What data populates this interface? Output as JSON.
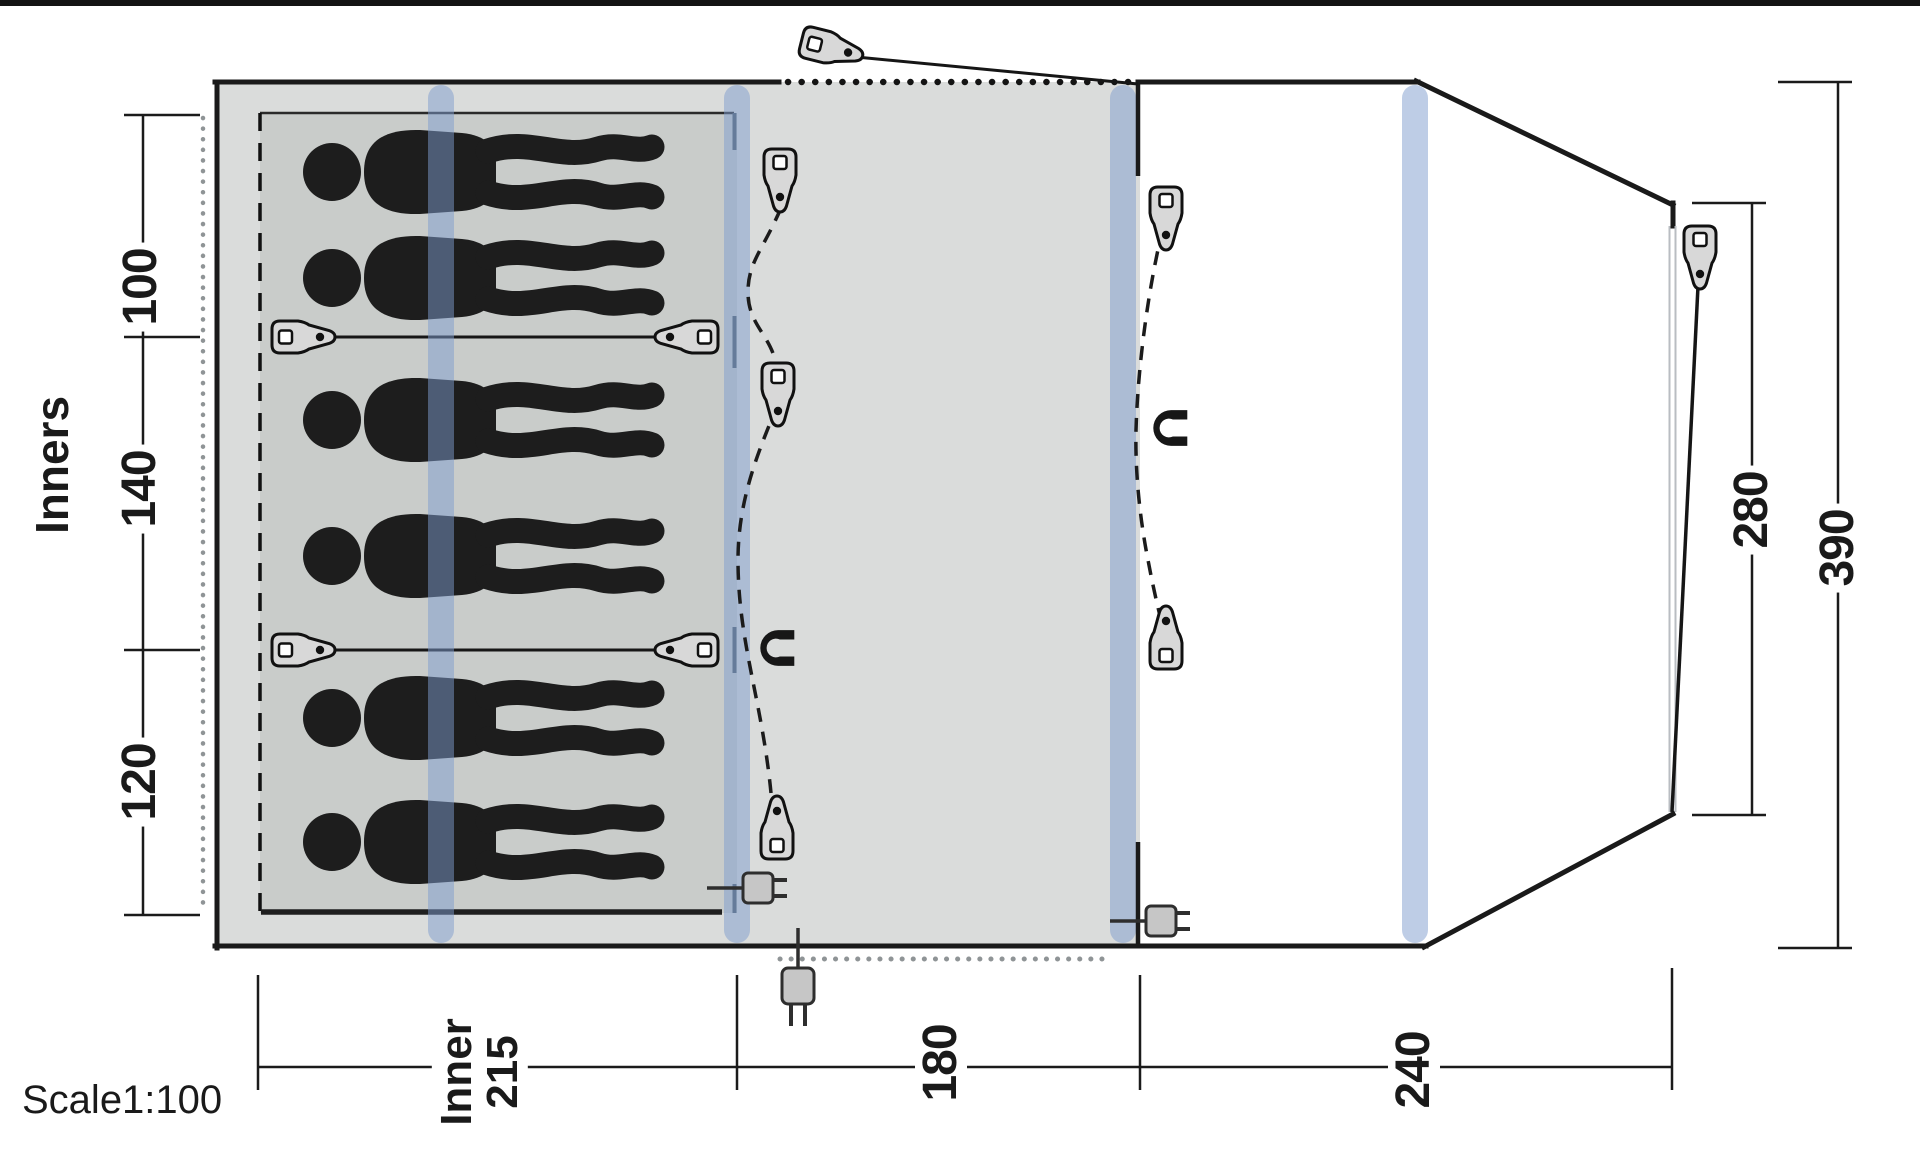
{
  "labels": {
    "inners": "Inners",
    "d100": "100",
    "d140": "140",
    "d120": "120",
    "inner_word": "Inner",
    "inner_value": "215",
    "d180": "180",
    "d240": "240",
    "d280": "280",
    "d390": "390",
    "scale": "Scale1:100"
  },
  "diagram": {
    "type": "tent-floorplan-top-view",
    "scale": "1:100",
    "sections": [
      {
        "name": "inner-sleeping-tent",
        "label": "Inner",
        "width_cm": 215,
        "compartment_widths_cm": [
          100,
          140,
          120
        ]
      },
      {
        "name": "living-area",
        "width_cm": 180
      },
      {
        "name": "front-porch",
        "width_cm": 240
      }
    ],
    "overall": {
      "tent_width_cm": 390,
      "front_width_cm": 280,
      "inner_total_width_cm": 360
    },
    "occupants": 6,
    "icon_counts": {
      "guy-peg": 11,
      "door-magnet": 2,
      "power-plug": 3,
      "pole-band": 4
    },
    "colors": {
      "outline": "#1a1a1a",
      "inner_floor": "#c9ccca",
      "living_floor": "#dadcdb",
      "porch_floor": "#ffffff",
      "pole_band_blue": "#7d9bcd",
      "wall_accent": "#4d5a66"
    }
  }
}
